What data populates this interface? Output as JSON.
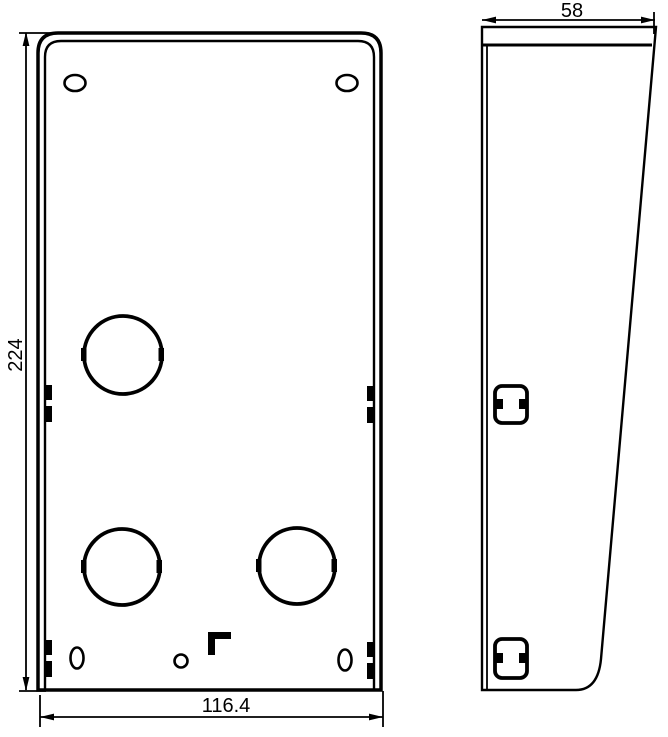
{
  "colors": {
    "background": "#ffffff",
    "line": "#000000"
  },
  "drawing": {
    "kind": "technical-drawing-two-views",
    "views": {
      "front": "front-view-protective-shield-plate",
      "side": "side-view-protective-shield-profile"
    },
    "dimensions": {
      "height": "224",
      "width": "116.4",
      "depth": "58"
    },
    "features": {
      "top_slot_count": 2,
      "knockout_circle_count": 3,
      "bottom_slot_count": 2,
      "side_latch_cutout_count": 2
    }
  }
}
